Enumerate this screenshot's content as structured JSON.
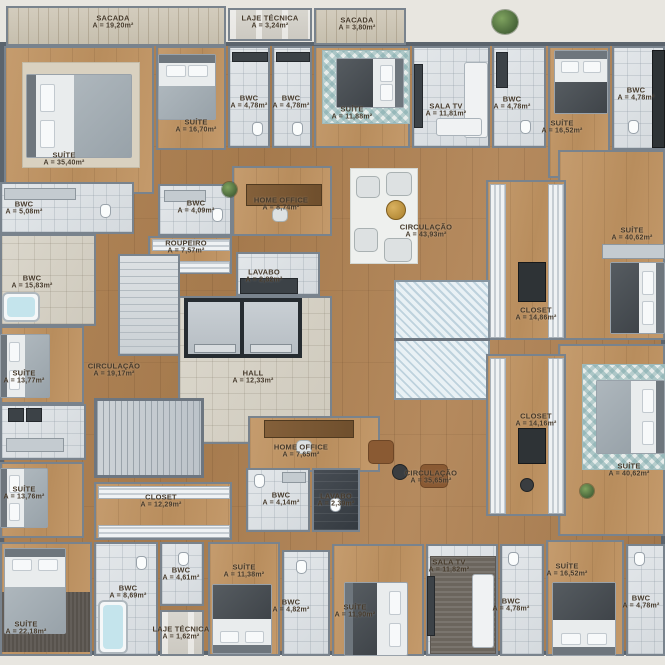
{
  "plan": {
    "type": "residential-floor-plan",
    "size_px": 665,
    "palette": {
      "outside": "#e8e6e0",
      "wood_floor": "#ad8154",
      "bedroom_wood": "#c0966a",
      "bathroom_tile": "#dde1e5",
      "dark_tile": "#3f454b",
      "hall_tile": "#d6d2c7",
      "wall": "#5b646d",
      "label_ink": "#463a2b",
      "teal_rug": "#7da8aa",
      "plant_green": "#5c7d46",
      "gold_table": "#b98a2e"
    },
    "rooms": [
      {
        "name": "SACADA",
        "area": "A = 19,20m²",
        "x": 113,
        "y": 22
      },
      {
        "name": "LAJE TÉCNICA",
        "area": "A = 3,24m²",
        "x": 270,
        "y": 22
      },
      {
        "name": "SACADA",
        "area": "A = 3,80m²",
        "x": 357,
        "y": 24
      },
      {
        "name": "SUÍTE",
        "area": "A = 35,40m²",
        "x": 64,
        "y": 159
      },
      {
        "name": "SUÍTE",
        "area": "A = 16,70m²",
        "x": 196,
        "y": 126
      },
      {
        "name": "BWC",
        "area": "A = 4,78m²",
        "x": 249,
        "y": 102
      },
      {
        "name": "BWC",
        "area": "A = 4,78m²",
        "x": 291,
        "y": 102
      },
      {
        "name": "SUÍTE",
        "area": "A = 11,88m²",
        "x": 352,
        "y": 113
      },
      {
        "name": "SALA TV",
        "area": "A = 11,81m²",
        "x": 446,
        "y": 110
      },
      {
        "name": "BWC",
        "area": "A = 4,78m²",
        "x": 512,
        "y": 103
      },
      {
        "name": "SUÍTE",
        "area": "A = 16,52m²",
        "x": 562,
        "y": 127
      },
      {
        "name": "BWC",
        "area": "A = 4,78m²",
        "x": 636,
        "y": 94
      },
      {
        "name": "SUÍTE",
        "area": "A = 40,62m²",
        "x": 632,
        "y": 234
      },
      {
        "name": "CLOSET",
        "area": "A = 14,86m²",
        "x": 536,
        "y": 314
      },
      {
        "name": "CIRCULAÇÃO",
        "area": "A = 43,93m²",
        "x": 426,
        "y": 231
      },
      {
        "name": "HOME OFFICE",
        "area": "A = 8,74m²",
        "x": 281,
        "y": 204
      },
      {
        "name": "BWC",
        "area": "A = 4,09m²",
        "x": 196,
        "y": 207
      },
      {
        "name": "BWC",
        "area": "A = 5,08m²",
        "x": 24,
        "y": 208
      },
      {
        "name": "ROUPEIRO",
        "area": "A = 7,57m²",
        "x": 186,
        "y": 247
      },
      {
        "name": "BWC",
        "area": "A = 15,83m²",
        "x": 32,
        "y": 282
      },
      {
        "name": "LAVABO",
        "area": "A = 2,82m²",
        "x": 264,
        "y": 276
      },
      {
        "name": "HALL",
        "area": "A = 12,33m²",
        "x": 253,
        "y": 377
      },
      {
        "name": "CIRCULAÇÃO",
        "area": "A = 19,17m²",
        "x": 114,
        "y": 370
      },
      {
        "name": "SUÍTE",
        "area": "A = 13,77m²",
        "x": 24,
        "y": 377
      },
      {
        "name": "SUÍTE",
        "area": "A = 13,76m²",
        "x": 24,
        "y": 493
      },
      {
        "name": "CLOSET",
        "area": "A = 12,29m²",
        "x": 161,
        "y": 501
      },
      {
        "name": "HOME OFFICE",
        "area": "A = 7,65m²",
        "x": 301,
        "y": 451
      },
      {
        "name": "CIRCULAÇÃO",
        "area": "A = 35,65m²",
        "x": 431,
        "y": 477
      },
      {
        "name": "BWC",
        "area": "A = 4,14m²",
        "x": 281,
        "y": 499
      },
      {
        "name": "LAVABO",
        "area": "A = 2,39m²",
        "x": 336,
        "y": 500
      },
      {
        "name": "CLOSET",
        "area": "A = 14,16m²",
        "x": 536,
        "y": 420
      },
      {
        "name": "SUÍTE",
        "area": "A = 40,62m²",
        "x": 629,
        "y": 470
      },
      {
        "name": "SUÍTE",
        "area": "A = 22,18m²",
        "x": 26,
        "y": 628
      },
      {
        "name": "BWC",
        "area": "A = 8,69m²",
        "x": 128,
        "y": 592
      },
      {
        "name": "BWC",
        "area": "A = 4,61m²",
        "x": 181,
        "y": 574
      },
      {
        "name": "LAJE TÉCNICA",
        "area": "A = 1,62m²",
        "x": 181,
        "y": 633
      },
      {
        "name": "SUÍTE",
        "area": "A = 11,38m²",
        "x": 244,
        "y": 571
      },
      {
        "name": "BWC",
        "area": "A = 4,82m²",
        "x": 291,
        "y": 606
      },
      {
        "name": "SUÍTE",
        "area": "A = 11,90m²",
        "x": 355,
        "y": 611
      },
      {
        "name": "SALA TV",
        "area": "A = 11,82m²",
        "x": 449,
        "y": 566
      },
      {
        "name": "BWC",
        "area": "A = 4,78m²",
        "x": 511,
        "y": 605
      },
      {
        "name": "SUÍTE",
        "area": "A = 16,52m²",
        "x": 567,
        "y": 570
      },
      {
        "name": "BWC",
        "area": "A = 4,78m²",
        "x": 641,
        "y": 602
      }
    ]
  }
}
